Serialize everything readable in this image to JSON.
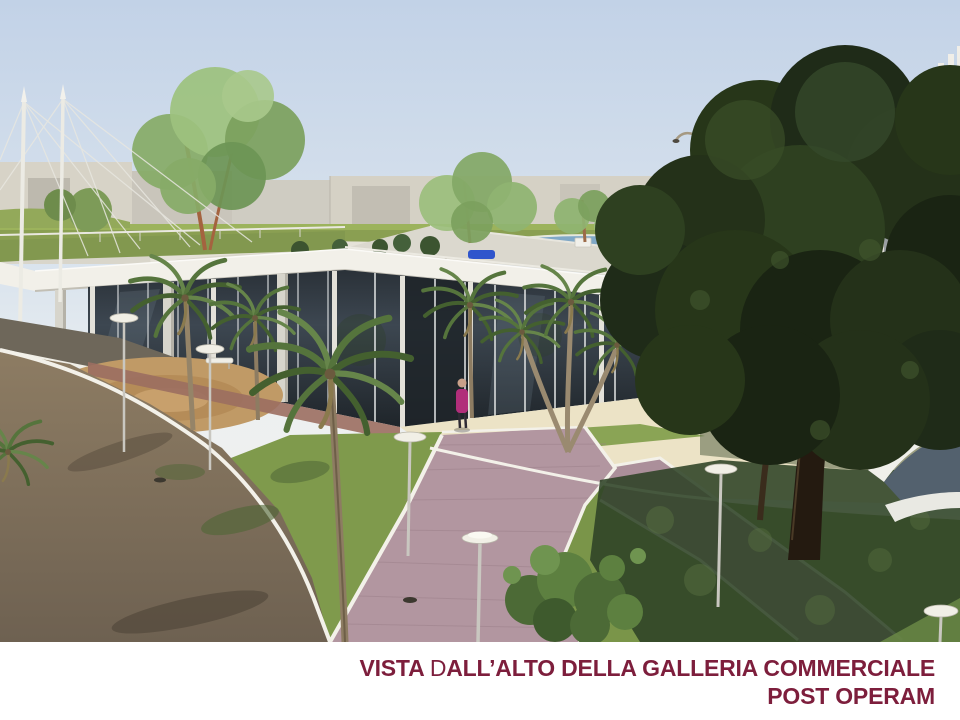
{
  "slide": {
    "background_color": "#ffffff",
    "caption": {
      "line1_part1": "VISTA ",
      "line1_part2": "D",
      "line1_part3": "ALL’ALTO DELLA GALLERIA COMMERCIALE",
      "line2": "POST OPERAM",
      "text_color": "#7d1e3c",
      "alignment": "right"
    },
    "render": {
      "alt": "Aerial 3D architectural rendering of the shopping gallery after completion: single-storey glass building with white roof deck and roof garden, palm trees, lawns, pink paved walkway, sandy plaza, large dark tree, louvered tower, distant warehouses under a clear sky",
      "scene_elements": [
        "sky",
        "distant-warehouses",
        "horizon-lawn",
        "perimeter-road",
        "gallery-building",
        "roof-garden",
        "rooftop-parking",
        "tensile-masts",
        "louvered-tower",
        "curved-pavilion",
        "large-tree",
        "palm-trees",
        "pedestrian",
        "street-lamps",
        "pedestrian-path",
        "lawns",
        "dirt-ground",
        "sand-plaza",
        "foreground-shrub"
      ],
      "key_colors": {
        "sky_top": "#c2d2e7",
        "sky_horizon": "#edf0f1",
        "roof_white": "#f2f0e9",
        "glass_dark": "#2e363d",
        "lawn_green": "#7f9a4c",
        "lawn_shadow": "#2e4226",
        "path_pink": "#b296a0",
        "dirt_brown": "#7e6f58",
        "sand_plaza": "#ece3c6",
        "tree_dark": "#24311a"
      }
    }
  }
}
